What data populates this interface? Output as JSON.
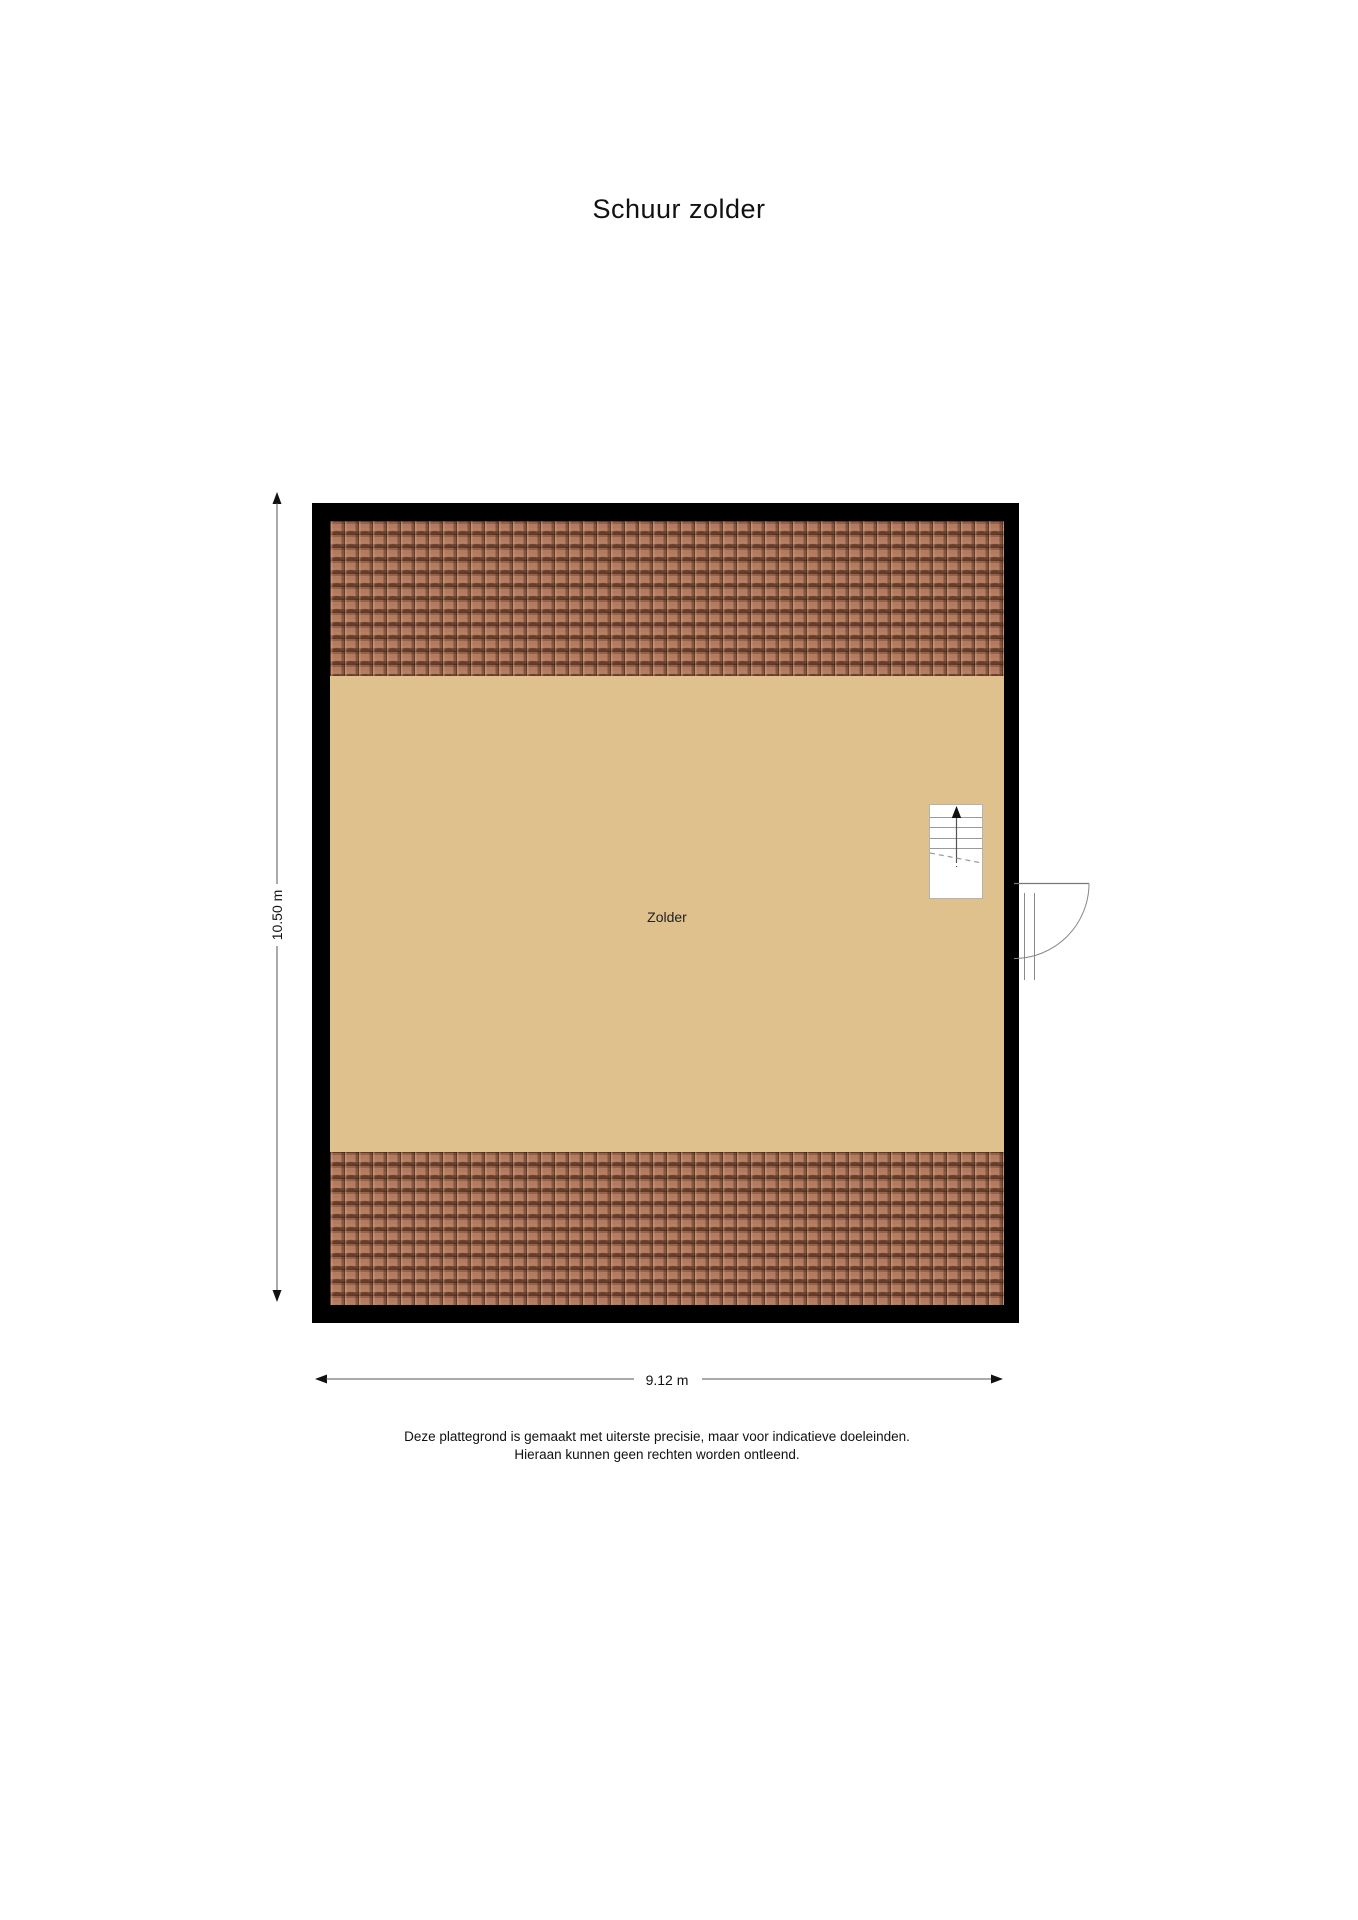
{
  "page": {
    "title": "Schuur zolder"
  },
  "floorplan": {
    "room_label": "Zolder",
    "width_dimension": "9.12 m",
    "height_dimension": "10.50 m",
    "features": {
      "stairs": "staircase with up-direction arrow and dashed cut line",
      "door": "single door on right wall swinging outward"
    },
    "colors": {
      "wall": "#000000",
      "floor": "#dfc18e",
      "roof_tile": "#a8715a",
      "roof_tile_shadow": "#4a2e22",
      "dimension_line": "#555555",
      "text": "#111111"
    }
  },
  "disclaimer": {
    "line1": "Deze plattegrond is gemaakt met uiterste precisie, maar voor indicatieve doeleinden.",
    "line2": "Hieraan kunnen geen rechten worden ontleend."
  }
}
